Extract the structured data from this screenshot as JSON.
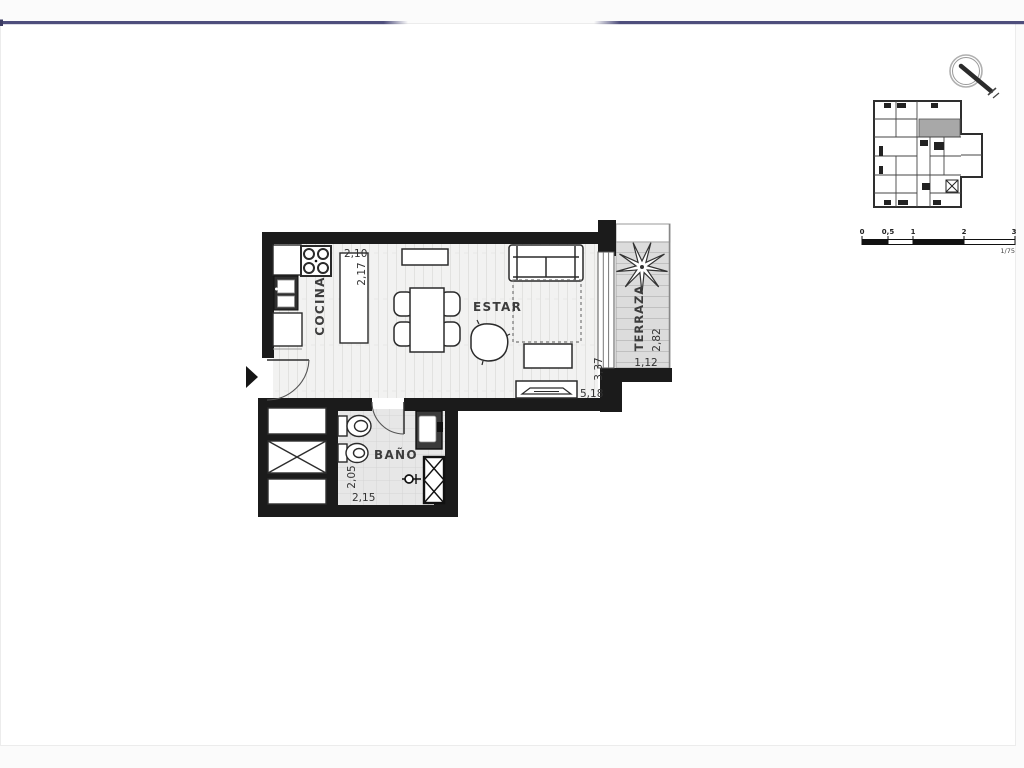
{
  "plan": {
    "rooms": {
      "cocina": {
        "label": "COCINA",
        "dim_a": "2,10",
        "dim_b": "2,17"
      },
      "estar": {
        "label": "ESTAR",
        "dim_a": "3,37",
        "dim_b": "5,18"
      },
      "terraza": {
        "label": "TERRAZA",
        "dim_a": "2,82",
        "dim_b": "1,12"
      },
      "bano": {
        "label": "BAÑO",
        "dim_a": "2,05",
        "dim_b": "2,15"
      }
    }
  },
  "scale_bar": {
    "ticks": [
      "0",
      "0,5",
      "1",
      "2",
      "3"
    ],
    "ratio": "1/75"
  },
  "colors": {
    "wall": "#1b1b1b",
    "accent_line": "#4e4e7c",
    "highlight_unit": "#a8a8a8",
    "wood_floor": "#f2f2f1",
    "tile_floor": "#e7e7e7",
    "deck_floor": "#dcdcdc"
  }
}
